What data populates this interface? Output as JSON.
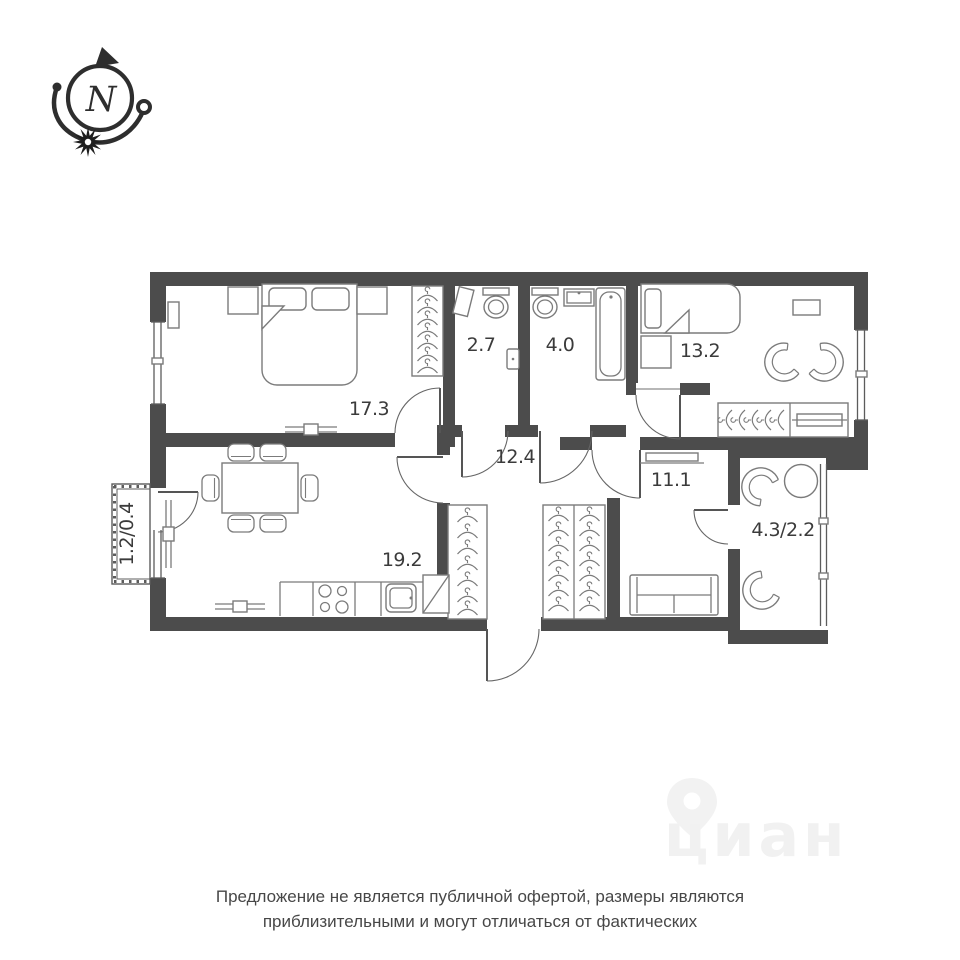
{
  "compass": {
    "letter": "N"
  },
  "floor_plan": {
    "rooms": [
      {
        "name": "bedroom-main",
        "area_label": "17.3"
      },
      {
        "name": "wc",
        "area_label": "2.7"
      },
      {
        "name": "bathroom",
        "area_label": "4.0"
      },
      {
        "name": "bedroom-second",
        "area_label": "13.2"
      },
      {
        "name": "hallway",
        "area_label": "12.4"
      },
      {
        "name": "room",
        "area_label": "11.1"
      },
      {
        "name": "kitchen-living",
        "area_label": "19.2"
      },
      {
        "name": "balcony-right",
        "area_label": "4.3/2.2"
      },
      {
        "name": "balcony-left",
        "area_label": "1.2/0.4"
      }
    ]
  },
  "watermark": {
    "brand": "циан"
  },
  "disclaimer": {
    "line1": "Предложение не является публичной офертой, размеры являются",
    "line2": "приблизительными и могут отличаться от фактических"
  },
  "colors": {
    "wall": "#4c4c4c",
    "furniture_line": "#7b7b7b",
    "label_text": "#3b3b3b",
    "disclaimer_text": "#474747",
    "watermark": "#f1f1f1"
  }
}
